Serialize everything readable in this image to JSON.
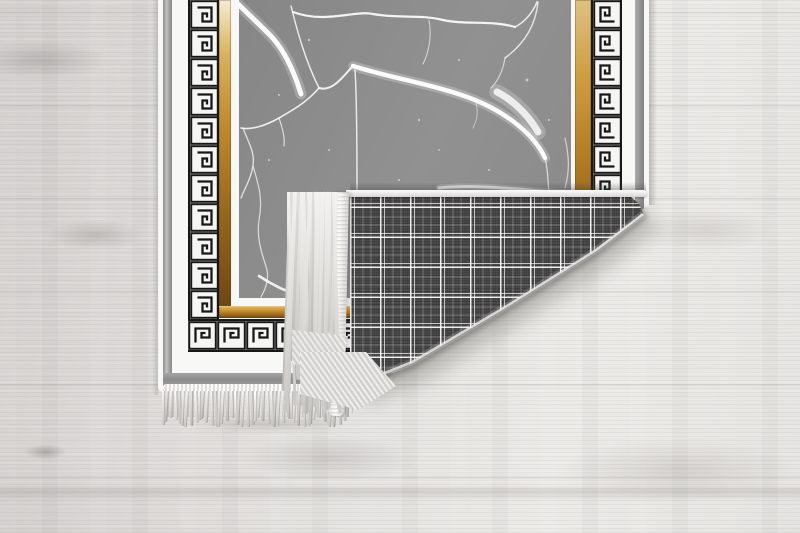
{
  "scene": {
    "type": "product-photo",
    "subject": "Area rug with black-and-white Greek key border, gold trim bands and gray marble-crack center field; bottom-right corner folded over showing dark plaid woven backing and cream fringe; lying on a light whitewashed wood plank floor",
    "no_visible_text": true
  },
  "palette": {
    "floor_mid": "#e0dedb",
    "floor_light": "#eceae7",
    "floor_dark": "#d2cfcd",
    "rug_white": "#f8f8f6",
    "band_gray": "#8f8f8f",
    "key_black": "#181818",
    "key_bg": "#f5f5f3",
    "gold_light": "#f0dfae",
    "gold_mid": "#c8942f",
    "gold_dark": "#6e4712",
    "marble_gray": "#8c8c8c",
    "crack_white": "#ffffff",
    "plaid_base": "#4d4d4d",
    "fringe_light": "#f3f2f0",
    "fringe_dark": "#c9c7c3",
    "shadow": "#5b5955"
  },
  "rug": {
    "greek_key": {
      "tile_px": 29,
      "bottom_count": 15,
      "side_count": 11
    },
    "fringe": {
      "bottom_count": 47,
      "fold_count": 52
    },
    "plaid_cell_px": 30
  },
  "marble": {
    "cracks": [
      {
        "d": "M-3 2 L30 34 C40 44 50 60 58 82 L62 94",
        "w": 5,
        "o": 0.95
      },
      {
        "d": "M52 6 C58 30 66 60 80 88",
        "w": 1.4,
        "o": 0.85
      },
      {
        "d": "M54 12 C86 24 116 10 134 14 C162 19 180 14 204 20 C226 25 252 20 276 27",
        "w": 2.2,
        "o": 0.9
      },
      {
        "d": "M276 27 C286 22 294 12 298 2",
        "w": 1.6,
        "o": 0.8
      },
      {
        "d": "M299 2 C297 22 288 42 266 58",
        "w": 1.4,
        "o": 0.75
      },
      {
        "d": "M80 88 C94 92 104 76 114 66",
        "w": 2,
        "o": 0.85
      },
      {
        "d": "M114 66 C152 78 202 86 236 100 C270 114 296 136 306 158",
        "w": 4.5,
        "o": 0.95
      },
      {
        "d": "M258 92 C274 100 290 116 299 132",
        "w": 7,
        "o": 0.8
      },
      {
        "d": "M266 58 C264 70 260 80 252 88",
        "w": 1.2,
        "o": 0.6
      },
      {
        "d": "M116 70 C118 100 118 150 118 194",
        "w": 1.5,
        "o": 0.8
      },
      {
        "d": "M190 20 C193 36 190 52 184 64",
        "w": 1.1,
        "o": 0.6
      },
      {
        "d": "M80 88 C68 102 54 110 40 118 C26 126 12 130 2 128",
        "w": 1.6,
        "o": 0.85
      },
      {
        "d": "M40 118 C44 130 46 138 45 146",
        "w": 1.2,
        "o": 0.7
      },
      {
        "d": "M4 128 C10 144 16 152 14 166 C12 178 6 188 2 198",
        "w": 1.3,
        "o": 0.75
      },
      {
        "d": "M14 166 C20 186 24 200 20 220 C17 240 24 256 28 270 C30 280 26 290 22 297",
        "w": 1.2,
        "o": 0.7
      },
      {
        "d": "M20 276 C32 284 48 292 64 297",
        "w": 2.6,
        "o": 0.85
      },
      {
        "d": "M306 158 C310 172 308 188 312 204 C314 218 310 232 309 242",
        "w": 1.2,
        "o": 0.7
      },
      {
        "d": "M200 188 C240 184 280 190 331 193",
        "w": 3,
        "o": 0.8
      },
      {
        "d": "M326 138 C330 156 331 170 326 188",
        "w": 1.2,
        "o": 0.6
      },
      {
        "d": "M236 100 C240 112 238 120 234 128",
        "w": 1,
        "o": 0.5
      }
    ],
    "speckles": [
      [
        70,
        40,
        1.2
      ],
      [
        90,
        150,
        1
      ],
      [
        40,
        95,
        1
      ],
      [
        220,
        60,
        1
      ],
      [
        180,
        120,
        1.1
      ],
      [
        250,
        170,
        1
      ],
      [
        60,
        210,
        1
      ],
      [
        100,
        250,
        1
      ],
      [
        160,
        180,
        1
      ],
      [
        288,
        80,
        1.4
      ],
      [
        310,
        120,
        1
      ],
      [
        30,
        160,
        1
      ],
      [
        140,
        230,
        1
      ],
      [
        200,
        150,
        0.9
      ],
      [
        270,
        200,
        1
      ]
    ]
  }
}
